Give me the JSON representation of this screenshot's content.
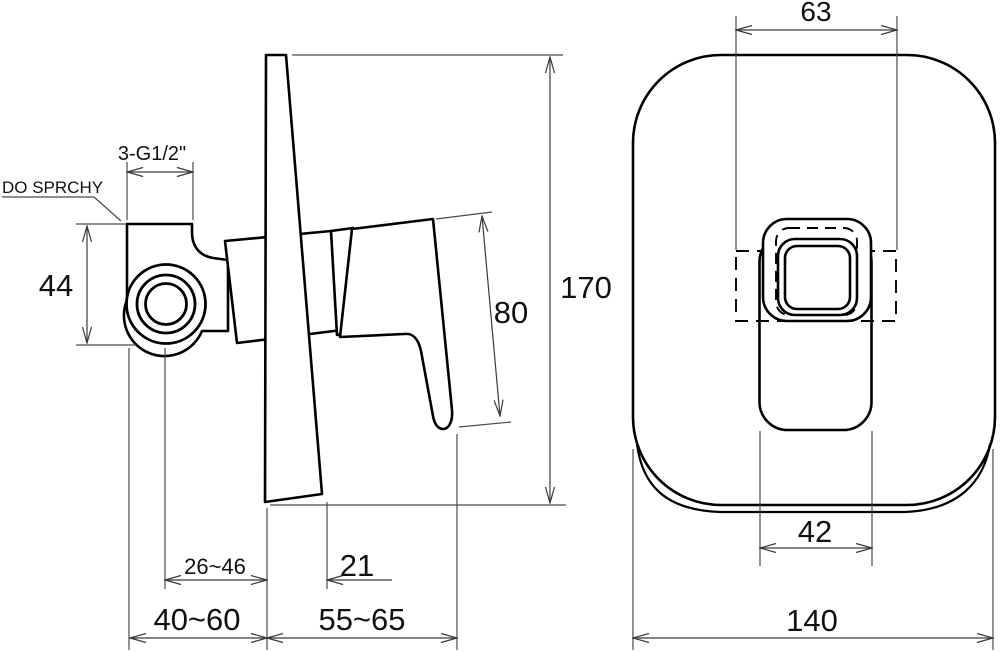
{
  "drawing": {
    "kind": "installation-dimension-drawing",
    "subject": "concealed single-lever shower mixer, side view and front view of trim plate",
    "labels": {
      "outlet_label": "DO SPRCHY",
      "thread_label": "3-G1/2\""
    },
    "side_view": {
      "total_height": "170",
      "handle_length": "80",
      "body_height": "44",
      "pipe_axis_depth_range": "26~46",
      "lever_base_offset": "21",
      "rough_in_depth_range": "40~60",
      "handle_projection_range": "55~65"
    },
    "front_view": {
      "rough_in_width": "63",
      "recess_width": "42",
      "plate_width": "140"
    },
    "colors": {
      "line": "#000000",
      "background": "#ffffff"
    }
  }
}
